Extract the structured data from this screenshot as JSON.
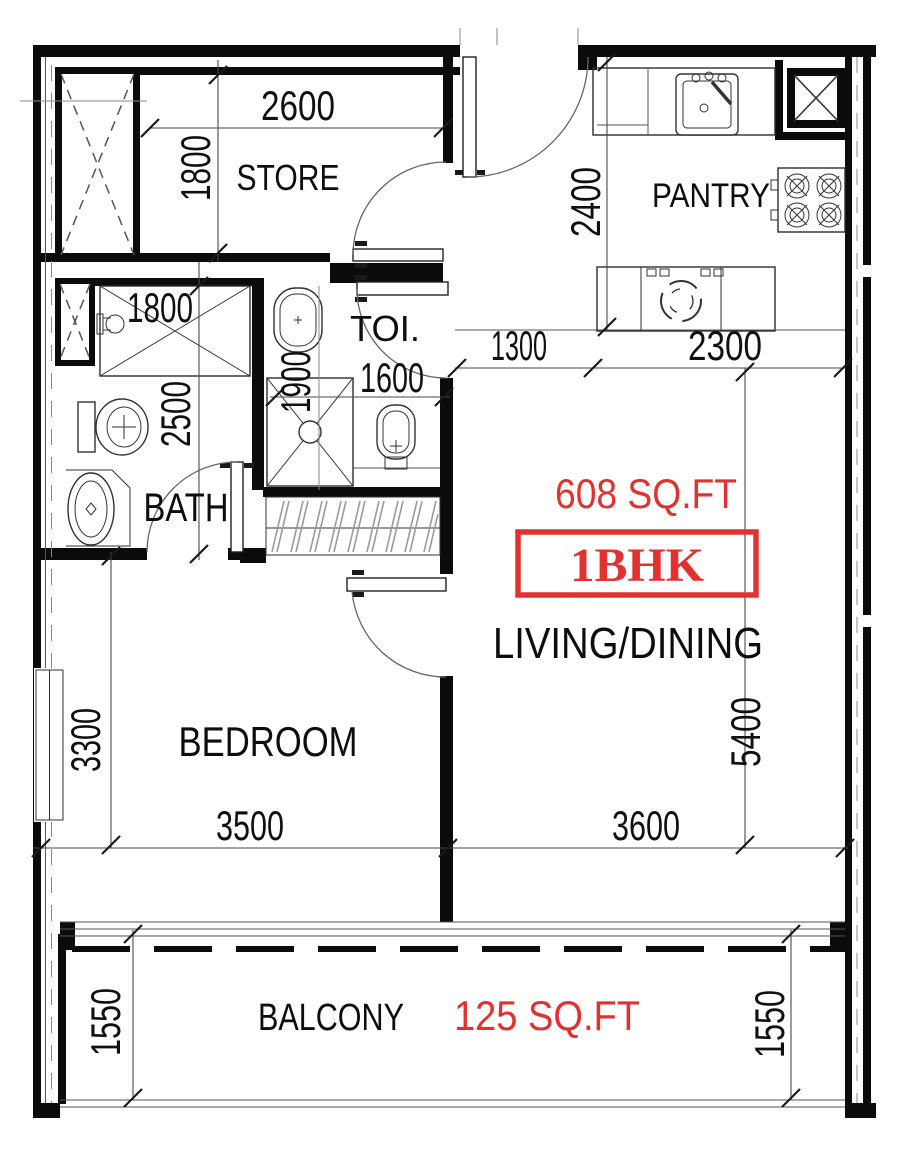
{
  "floor_plan": {
    "badge": {
      "unit_type": "1BHK",
      "total_area": "608 SQ.FT",
      "balcony_area": "125 SQ.FT"
    },
    "rooms": {
      "store": {
        "label": "STORE",
        "width_mm": "2600",
        "depth_mm": "1800"
      },
      "pantry": {
        "label": "PANTRY",
        "depth_mm": "2400",
        "width_mm": "2300"
      },
      "toilet": {
        "label": "TOI.",
        "depth_mm": "1900",
        "width_mm": "1600"
      },
      "bath": {
        "label": "BATH",
        "width_mm": "1800",
        "depth_mm": "2500"
      },
      "living": {
        "label": "LIVING/DINING",
        "width_mm": "3600",
        "depth_mm": "5400"
      },
      "bedroom": {
        "label": "BEDROOM",
        "width_mm": "3500",
        "depth_mm": "3300"
      },
      "balcony": {
        "label": "BALCONY",
        "depth_left_mm": "1550",
        "depth_right_mm": "1550"
      },
      "hall": {
        "width_mm": "1300"
      }
    },
    "colors": {
      "accent_red": "#e2312e",
      "wall_black": "#0b0b0b",
      "line_gray": "#555555"
    }
  }
}
